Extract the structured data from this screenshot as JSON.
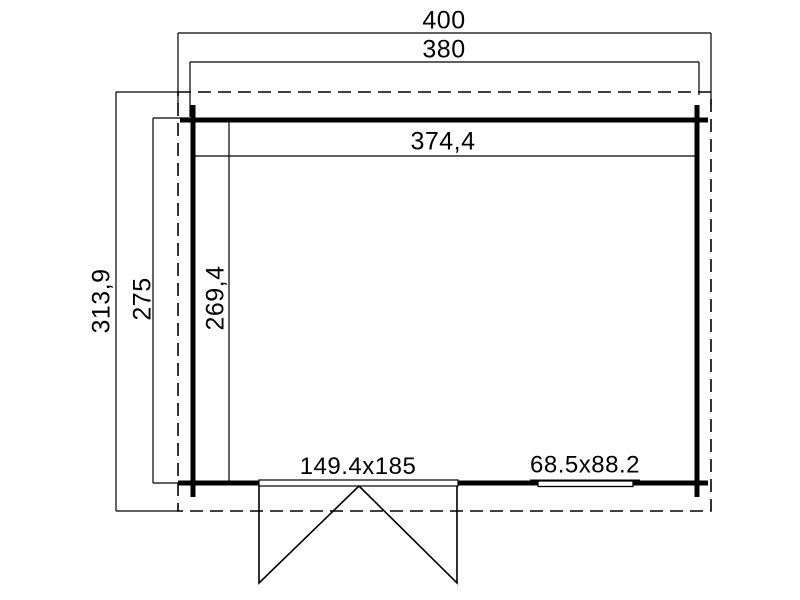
{
  "drawing": {
    "type": "floor-plan",
    "colors": {
      "line": "#000000",
      "background": "#ffffff"
    },
    "dimensions": {
      "roof_width": "400",
      "wall_outer_width": "380",
      "inner_width": "374,4",
      "roof_depth": "313,9",
      "wall_outer_depth": "275",
      "inner_depth": "269,4"
    },
    "openings": {
      "door": {
        "label": "149.4x185"
      },
      "window": {
        "label": "68.5x88.2"
      }
    }
  }
}
